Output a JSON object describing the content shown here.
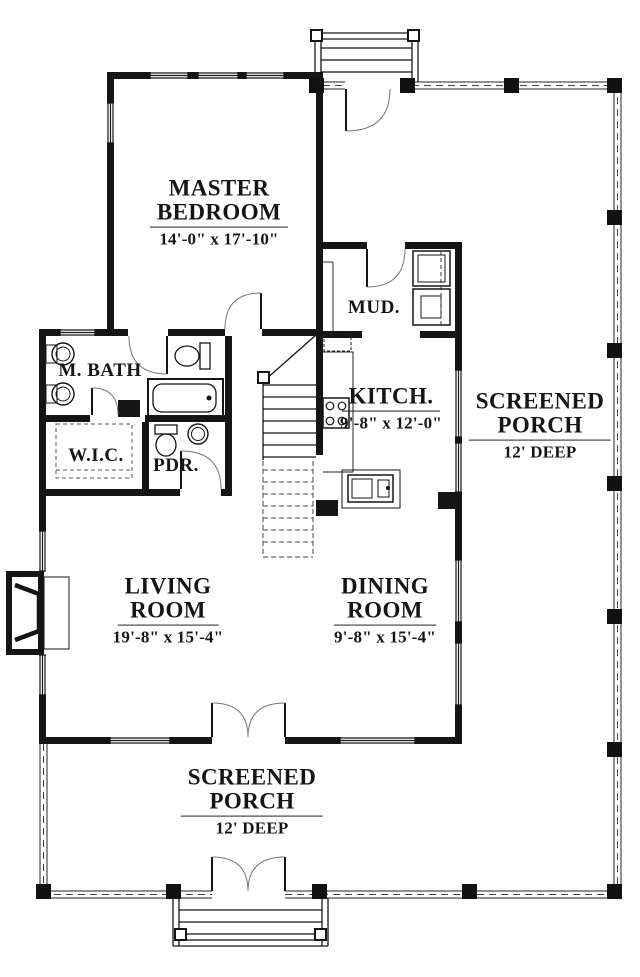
{
  "plan": {
    "title": "first-floor-plan",
    "rooms": [
      {
        "id": "master-bedroom",
        "name": "MASTER\nBEDROOM",
        "dims": "14'-0\" x 17'-10\""
      },
      {
        "id": "m-bath",
        "name": "M. BATH",
        "dims": ""
      },
      {
        "id": "wic",
        "name": "W.I.C.",
        "dims": ""
      },
      {
        "id": "pdr",
        "name": "PDR.",
        "dims": ""
      },
      {
        "id": "mud",
        "name": "MUD.",
        "dims": ""
      },
      {
        "id": "kitchen",
        "name": "KITCH.",
        "dims": "9'-8\" x 12'-0\""
      },
      {
        "id": "screened-porch-right",
        "name": "SCREENED\nPORCH",
        "dims": "12' DEEP"
      },
      {
        "id": "living-room",
        "name": "LIVING\nROOM",
        "dims": "19'-8\" x 15'-4\""
      },
      {
        "id": "dining-room",
        "name": "DINING\nROOM",
        "dims": "9'-8\" x 15'-4\""
      },
      {
        "id": "screened-porch-bottom",
        "name": "SCREENED\nPORCH",
        "dims": "12' DEEP"
      }
    ],
    "colors": {
      "wall": "#151515",
      "thin_line": "#222222",
      "arc": "#777777",
      "background": "#ffffff"
    }
  }
}
